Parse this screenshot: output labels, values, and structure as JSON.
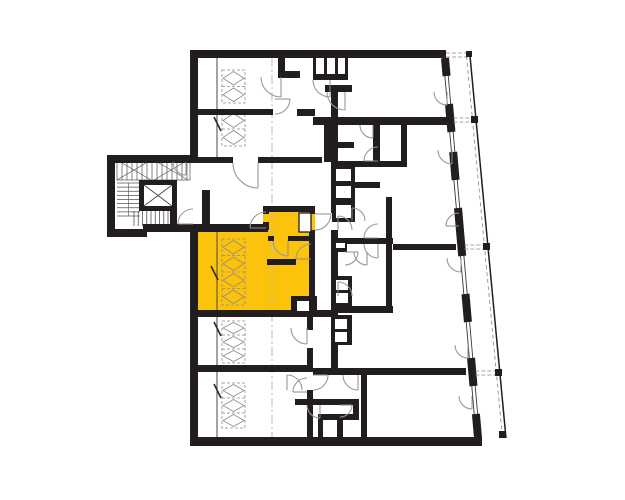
{
  "meta": {
    "kind": "architectural-floor-plan",
    "canvas_w": 625,
    "canvas_h": 500
  },
  "colors": {
    "background": "#ffffff",
    "wall": "#221e1f",
    "highlight": "#fcc30c",
    "arc_line": "#9c989a",
    "leaf_line": "#8f8b8d",
    "thin_line": "#4a4647",
    "hatch_line": "#8e8a8c",
    "centerline": "#bcbcbc",
    "stair_line": "#555152",
    "glazing_line": "#3a3637",
    "divider_dash": "#8a8687"
  },
  "highlight_unit": {
    "points": "198,224 263,224 263,206 315,206 315,316 198,316",
    "label": "selected-unit"
  },
  "walls": [
    {
      "n": "outer-top-wall",
      "x": 190,
      "y": 50,
      "w": 256,
      "h": 8
    },
    {
      "n": "outer-left-upper-wall",
      "x": 190,
      "y": 50,
      "w": 8,
      "h": 112
    },
    {
      "n": "stairwing-top-wall",
      "x": 112,
      "y": 155,
      "w": 82,
      "h": 7
    },
    {
      "n": "stairwing-left-wall",
      "x": 107,
      "y": 155,
      "w": 8,
      "h": 82
    },
    {
      "n": "stairwing-bottom-wall",
      "x": 107,
      "y": 229,
      "w": 40,
      "h": 8
    },
    {
      "n": "corridor-bottom-wall",
      "x": 143,
      "y": 224,
      "w": 125,
      "h": 8
    },
    {
      "n": "outer-left-main-wall",
      "x": 190,
      "y": 224,
      "w": 8,
      "h": 221
    },
    {
      "n": "outer-bottom-wall",
      "x": 190,
      "y": 437,
      "w": 292,
      "h": 9
    },
    {
      "n": "corridor-top-wall-a",
      "x": 112,
      "y": 157,
      "w": 121,
      "h": 6
    },
    {
      "n": "corridor-top-wall-b",
      "x": 258,
      "y": 157,
      "w": 64,
      "h": 6
    },
    {
      "n": "niche-wall",
      "x": 202,
      "y": 190,
      "w": 8,
      "h": 40
    },
    {
      "n": "topunit-partition-wall",
      "x": 198,
      "y": 109,
      "w": 75,
      "h": 6
    },
    {
      "n": "topunit-stub-v",
      "x": 278,
      "y": 58,
      "w": 7,
      "h": 20
    },
    {
      "n": "topunit-stub-h",
      "x": 281,
      "y": 71,
      "w": 19,
      "h": 7
    },
    {
      "n": "entry-stub",
      "x": 297,
      "y": 109,
      "w": 18,
      "h": 7
    },
    {
      "n": "cells-bottom-wall",
      "x": 313,
      "y": 74,
      "w": 35,
      "h": 6
    },
    {
      "n": "cells-divider",
      "x": 313,
      "y": 58,
      "w": 3,
      "h": 16
    },
    {
      "n": "cells-divider",
      "x": 324,
      "y": 58,
      "w": 3,
      "h": 16
    },
    {
      "n": "cells-divider",
      "x": 335,
      "y": 58,
      "w": 3,
      "h": 16
    },
    {
      "n": "cells-divider",
      "x": 345,
      "y": 58,
      "w": 3,
      "h": 16
    },
    {
      "n": "center-top-stub",
      "x": 325,
      "y": 85,
      "w": 27,
      "h": 7
    },
    {
      "n": "center-left-wall",
      "x": 331,
      "y": 92,
      "w": 7,
      "h": 121
    },
    {
      "n": "center-left-wall",
      "x": 331,
      "y": 230,
      "w": 7,
      "h": 50
    },
    {
      "n": "center-left-wall",
      "x": 331,
      "y": 296,
      "w": 7,
      "h": 74
    },
    {
      "n": "unit-divider-wall",
      "x": 313,
      "y": 117,
      "w": 139,
      "h": 8
    },
    {
      "n": "strip-wall",
      "x": 324,
      "y": 124,
      "w": 7,
      "h": 38
    },
    {
      "n": "room-wall",
      "x": 373,
      "y": 125,
      "w": 7,
      "h": 36
    },
    {
      "n": "room-wall",
      "x": 328,
      "y": 142,
      "w": 26,
      "h": 6
    },
    {
      "n": "room-wall",
      "x": 331,
      "y": 161,
      "w": 76,
      "h": 6
    },
    {
      "n": "room-wall",
      "x": 401,
      "y": 117,
      "w": 6,
      "h": 50
    },
    {
      "n": "room-wall",
      "x": 355,
      "y": 182,
      "w": 25,
      "h": 6
    },
    {
      "n": "room-wall",
      "x": 386,
      "y": 197,
      "w": 6,
      "h": 110
    },
    {
      "n": "unit-divider-wall",
      "x": 331,
      "y": 238,
      "w": 62,
      "h": 6
    },
    {
      "n": "unit-divider-wall",
      "x": 393,
      "y": 244,
      "w": 63,
      "h": 6
    },
    {
      "n": "room-wall",
      "x": 331,
      "y": 306,
      "w": 62,
      "h": 7
    },
    {
      "n": "unit-bottom-wall",
      "x": 198,
      "y": 310,
      "w": 133,
      "h": 7
    },
    {
      "n": "unit-divider-wall",
      "x": 198,
      "y": 365,
      "w": 115,
      "h": 7
    },
    {
      "n": "unit-divider-wall",
      "x": 313,
      "y": 368,
      "w": 153,
      "h": 7
    },
    {
      "n": "rooms-right-wall",
      "x": 307,
      "y": 317,
      "w": 6,
      "h": 13
    },
    {
      "n": "rooms-right-wall",
      "x": 307,
      "y": 348,
      "w": 6,
      "h": 24
    },
    {
      "n": "rooms-right-wall",
      "x": 307,
      "y": 390,
      "w": 6,
      "h": 47
    },
    {
      "n": "entry-wall",
      "x": 295,
      "y": 399,
      "w": 60,
      "h": 6
    },
    {
      "n": "entry-wall",
      "x": 307,
      "y": 405,
      "w": 6,
      "h": 32
    },
    {
      "n": "entry-wall",
      "x": 318,
      "y": 414,
      "w": 41,
      "h": 6
    },
    {
      "n": "entry-wall",
      "x": 318,
      "y": 420,
      "w": 5,
      "h": 17
    },
    {
      "n": "entry-wall",
      "x": 337,
      "y": 420,
      "w": 6,
      "h": 17
    },
    {
      "n": "entry-wall",
      "x": 353,
      "y": 399,
      "w": 6,
      "h": 21
    },
    {
      "n": "entry-wall",
      "x": 361,
      "y": 375,
      "w": 6,
      "h": 62
    },
    {
      "n": "stair-right-wall",
      "x": 170,
      "y": 207,
      "w": 7,
      "h": 17
    },
    {
      "n": "unit-room-top-wall",
      "x": 198,
      "y": 224,
      "w": 70,
      "h": 6
    },
    {
      "n": "vestibule-wall",
      "x": 263,
      "y": 206,
      "w": 6,
      "h": 8
    },
    {
      "n": "vestibule-wall",
      "x": 263,
      "y": 222,
      "w": 6,
      "h": 8
    },
    {
      "n": "vestibule-top-wall",
      "x": 263,
      "y": 206,
      "w": 52,
      "h": 6
    },
    {
      "n": "unit-right-wall",
      "x": 309,
      "y": 206,
      "w": 6,
      "h": 8
    },
    {
      "n": "unit-right-wall",
      "x": 309,
      "y": 230,
      "w": 6,
      "h": 84
    },
    {
      "n": "bath-wall",
      "x": 268,
      "y": 236,
      "w": 6,
      "h": 5
    },
    {
      "n": "bath-wall",
      "x": 288,
      "y": 236,
      "w": 27,
      "h": 5
    },
    {
      "n": "inner-wall",
      "x": 267,
      "y": 259,
      "w": 29,
      "h": 6
    },
    {
      "n": "inner-wall",
      "x": 311,
      "y": 259,
      "w": 4,
      "h": 6
    }
  ],
  "black_boxes": [
    {
      "n": "shaft-block",
      "x": 332,
      "y": 165,
      "w": 23,
      "h": 57
    },
    {
      "n": "shaft-block",
      "x": 331,
      "y": 276,
      "w": 21,
      "h": 32
    },
    {
      "n": "shaft-block",
      "x": 331,
      "y": 315,
      "w": 21,
      "h": 30
    },
    {
      "n": "bath-notch",
      "x": 291,
      "y": 296,
      "w": 26,
      "h": 20
    },
    {
      "n": "duct-block",
      "x": 331,
      "y": 240,
      "w": 16,
      "h": 12
    }
  ],
  "white_boxes": [
    {
      "n": "shaft-cell",
      "x": 336,
      "y": 169,
      "w": 15,
      "h": 12
    },
    {
      "n": "shaft-cell",
      "x": 336,
      "y": 186,
      "w": 15,
      "h": 12
    },
    {
      "n": "shaft-cell",
      "x": 336,
      "y": 205,
      "w": 15,
      "h": 13
    },
    {
      "n": "shaft-cell",
      "x": 336,
      "y": 280,
      "w": 12,
      "h": 10
    },
    {
      "n": "shaft-cell",
      "x": 336,
      "y": 293,
      "w": 12,
      "h": 10
    },
    {
      "n": "shaft-cell",
      "x": 335,
      "y": 319,
      "w": 12,
      "h": 10
    },
    {
      "n": "shaft-cell",
      "x": 335,
      "y": 332,
      "w": 12,
      "h": 10
    },
    {
      "n": "notch-cell",
      "x": 297,
      "y": 301,
      "w": 12,
      "h": 10
    },
    {
      "n": "duct-slot",
      "x": 336,
      "y": 243,
      "w": 9,
      "h": 5
    },
    {
      "n": "bath-shaft",
      "x": 299,
      "y": 213,
      "w": 12,
      "h": 19,
      "stroke": true
    }
  ],
  "door_arcs": [
    {
      "n": "corridor-door-arc",
      "cx": 258,
      "cy": 163,
      "r": 25,
      "a0": 90,
      "a1": 180
    },
    {
      "n": "topleft-unit-door-arc",
      "cx": 281,
      "cy": 77,
      "r": 20,
      "a0": 90,
      "a1": 180
    },
    {
      "n": "storage-door-arc",
      "cx": 330,
      "cy": 80,
      "r": 17,
      "a0": 90,
      "a1": 180
    },
    {
      "n": "corridor-mid-door-arc",
      "cx": 345,
      "cy": 92,
      "r": 18,
      "a0": 90,
      "a1": 180
    },
    {
      "n": "niche-door-arc",
      "cx": 275,
      "cy": 99,
      "r": 15,
      "a0": 0,
      "a1": 90
    },
    {
      "n": "stair-door-arc",
      "cx": 193,
      "cy": 224,
      "r": 15,
      "a0": 180,
      "a1": 270
    },
    {
      "n": "stair-room-door-arc",
      "cx": 186,
      "cy": 162,
      "r": 13,
      "a0": 90,
      "a1": 180
    },
    {
      "n": "unit-entry-door-arc",
      "cx": 315,
      "cy": 214,
      "r": 16,
      "a0": 0,
      "a1": 90
    },
    {
      "n": "vestibule-door-arc",
      "cx": 266,
      "cy": 228,
      "r": 16,
      "a0": 180,
      "a1": 270
    },
    {
      "n": "bathroom-door-arc",
      "cx": 288,
      "cy": 241,
      "r": 15,
      "a0": 90,
      "a1": 180
    },
    {
      "n": "inner-door-arc",
      "cx": 311,
      "cy": 259,
      "r": 15,
      "a0": 180,
      "a1": 270
    },
    {
      "n": "center-door-arc",
      "cx": 338,
      "cy": 230,
      "r": 14,
      "a0": 270,
      "a1": 360
    },
    {
      "n": "center-door-arc",
      "cx": 338,
      "cy": 296,
      "r": 14,
      "a0": 270,
      "a1": 360
    },
    {
      "n": "room-door-arc",
      "cx": 378,
      "cy": 238,
      "r": 14,
      "a0": 180,
      "a1": 270
    },
    {
      "n": "room-door-arc",
      "cx": 378,
      "cy": 244,
      "r": 14,
      "a0": 90,
      "a1": 180
    },
    {
      "n": "room-door-arc",
      "cx": 345,
      "cy": 252,
      "r": 13,
      "a0": 0,
      "a1": 90
    },
    {
      "n": "room-door-arc",
      "cx": 367,
      "cy": 252,
      "r": 13,
      "a0": 90,
      "a1": 180
    },
    {
      "n": "room-door-arc",
      "cx": 373,
      "cy": 125,
      "r": 13,
      "a0": 90,
      "a1": 180
    },
    {
      "n": "room-door-arc",
      "cx": 378,
      "cy": 161,
      "r": 14,
      "a0": 180,
      "a1": 270
    },
    {
      "n": "shaft-door-arc",
      "cx": 352,
      "cy": 221,
      "r": 13,
      "a0": 270,
      "a1": 360
    },
    {
      "n": "room-door-arc",
      "cx": 307,
      "cy": 328,
      "r": 16,
      "a0": 90,
      "a1": 180
    },
    {
      "n": "room-door-arc",
      "cx": 287,
      "cy": 390,
      "r": 15,
      "a0": 270,
      "a1": 360
    },
    {
      "n": "room-door-arc",
      "cx": 307,
      "cy": 392,
      "r": 14,
      "a0": 180,
      "a1": 270
    },
    {
      "n": "entry-door-arc",
      "cx": 313,
      "cy": 375,
      "r": 15,
      "a0": 0,
      "a1": 90
    },
    {
      "n": "entry-door-arc",
      "cx": 358,
      "cy": 375,
      "r": 15,
      "a0": 90,
      "a1": 180
    },
    {
      "n": "entry-door-arc",
      "cx": 320,
      "cy": 405,
      "r": 13,
      "a0": 90,
      "a1": 180
    },
    {
      "n": "entry-door-arc",
      "cx": 340,
      "cy": 405,
      "r": 12,
      "a0": 0,
      "a1": 90
    },
    {
      "n": "balcony-door-arc",
      "cx": 447,
      "cy": 92,
      "r": 13,
      "a0": 90,
      "a1": 180
    },
    {
      "n": "balcony-door-arc",
      "cx": 452,
      "cy": 150,
      "r": 14,
      "a0": 90,
      "a1": 180
    },
    {
      "n": "balcony-door-arc",
      "cx": 459,
      "cy": 226,
      "r": 13,
      "a0": 180,
      "a1": 270
    },
    {
      "n": "balcony-door-arc",
      "cx": 461,
      "cy": 258,
      "r": 14,
      "a0": 90,
      "a1": 180
    },
    {
      "n": "balcony-door-arc",
      "cx": 468,
      "cy": 345,
      "r": 13,
      "a0": 90,
      "a1": 180
    },
    {
      "n": "balcony-door-arc",
      "cx": 472,
      "cy": 396,
      "r": 13,
      "a0": 90,
      "a1": 180
    }
  ],
  "door_leaves": [
    {
      "n": "door-leaf",
      "x1": 214,
      "y1": 117,
      "x2": 221,
      "y2": 131
    },
    {
      "n": "door-leaf",
      "x1": 211,
      "y1": 266,
      "x2": 218,
      "y2": 280
    },
    {
      "n": "door-leaf",
      "x1": 214,
      "y1": 322,
      "x2": 221,
      "y2": 336
    },
    {
      "n": "door-leaf",
      "x1": 214,
      "y1": 384,
      "x2": 221,
      "y2": 398
    }
  ],
  "closet_hatches": [
    {
      "n": "closet-hatch",
      "x": 222,
      "y": 70,
      "w": 23,
      "h": 33,
      "cells": 2
    },
    {
      "n": "closet-hatch",
      "x": 222,
      "y": 112,
      "w": 23,
      "h": 34,
      "cells": 2
    },
    {
      "n": "closet-hatch",
      "x": 222,
      "y": 239,
      "w": 23,
      "h": 66,
      "cells": 4
    },
    {
      "n": "closet-hatch",
      "x": 222,
      "y": 321,
      "w": 23,
      "h": 42,
      "cells": 3
    },
    {
      "n": "closet-hatch",
      "x": 222,
      "y": 383,
      "w": 23,
      "h": 45,
      "cells": 3
    }
  ],
  "thin_lines": [
    {
      "n": "partition-line",
      "x1": 217,
      "y1": 58,
      "x2": 217,
      "y2": 157
    },
    {
      "n": "partition-line",
      "x1": 217,
      "y1": 230,
      "x2": 217,
      "y2": 310
    },
    {
      "n": "partition-line",
      "x1": 217,
      "y1": 317,
      "x2": 217,
      "y2": 365
    },
    {
      "n": "partition-line",
      "x1": 217,
      "y1": 372,
      "x2": 217,
      "y2": 437
    }
  ],
  "centerlines": [
    {
      "n": "grid-centerline",
      "x1": 272,
      "y1": 58,
      "x2": 272,
      "y2": 437
    }
  ],
  "stairs": {
    "top_band": {
      "x": 117,
      "y": 160,
      "w": 73,
      "h": 20,
      "step": 5
    },
    "flight_vertical": {
      "x": 117,
      "y": 183,
      "w": 23,
      "h": 33,
      "n": 9
    },
    "flight_horizontal": {
      "x": 134,
      "y": 211,
      "w": 34,
      "h": 15,
      "n": 9
    }
  },
  "elevator": {
    "n": "elevator-shaft",
    "x": 139,
    "y": 180,
    "w": 38,
    "h": 31,
    "wall": 5
  },
  "facade": {
    "glazing": {
      "x0": 445,
      "y0": 58,
      "x1": 478,
      "y1": 438,
      "gap": 3.4
    },
    "piers": [
      [
        58,
        76
      ],
      [
        104,
        132
      ],
      [
        152,
        180
      ],
      [
        208,
        256
      ],
      [
        294,
        322
      ],
      [
        358,
        386
      ],
      [
        414,
        438
      ]
    ],
    "outer_line": {
      "x0": 470,
      "y0": 56,
      "x1": 506,
      "y1": 438
    },
    "outer_dash": {
      "x0": 466.5,
      "y0": 56,
      "x1": 502.5,
      "y1": 438
    },
    "dividers": [
      120,
      247,
      373
    ],
    "top_rail": {
      "x0": 446,
      "x1": 469,
      "y": 55
    },
    "squares": [
      {
        "x": 466,
        "y": 51,
        "s": 6
      },
      {
        "x": 471,
        "y": 116,
        "s": 7
      },
      {
        "x": 483,
        "y": 243,
        "s": 7
      },
      {
        "x": 495,
        "y": 369,
        "s": 7
      },
      {
        "x": 499,
        "y": 431,
        "s": 7
      }
    ]
  }
}
